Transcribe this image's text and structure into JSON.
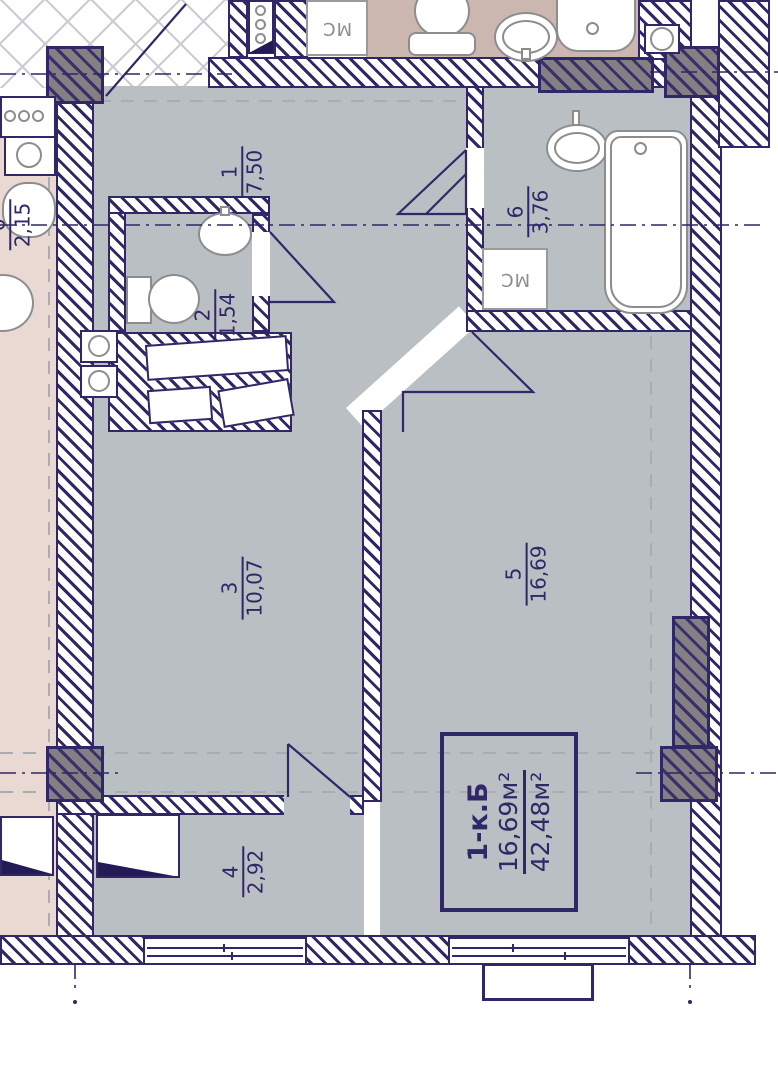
{
  "plan": {
    "info_box": {
      "type": "1-к.Б",
      "living_area": "16,69м²",
      "total_area": "42,48м²"
    },
    "rooms": [
      {
        "number": "1",
        "area": "7,50"
      },
      {
        "number": "2",
        "area": "1,54"
      },
      {
        "number": "3",
        "area": "10,07"
      },
      {
        "number": "4",
        "area": "2,92"
      },
      {
        "number": "5",
        "area": "16,69"
      },
      {
        "number": "6",
        "area": "3,76"
      }
    ],
    "adjacent_room": {
      "number": "6",
      "area": "2,15"
    },
    "duct_labels": [
      "МС",
      "МС"
    ],
    "colors": {
      "line_navy": "#2f2768",
      "room_fill": "#b9bfc3",
      "adjacent_fill_top": "#cbb7b0",
      "adjacent_fill_left": "#ead9d3",
      "column_fill": "#847f83"
    }
  }
}
